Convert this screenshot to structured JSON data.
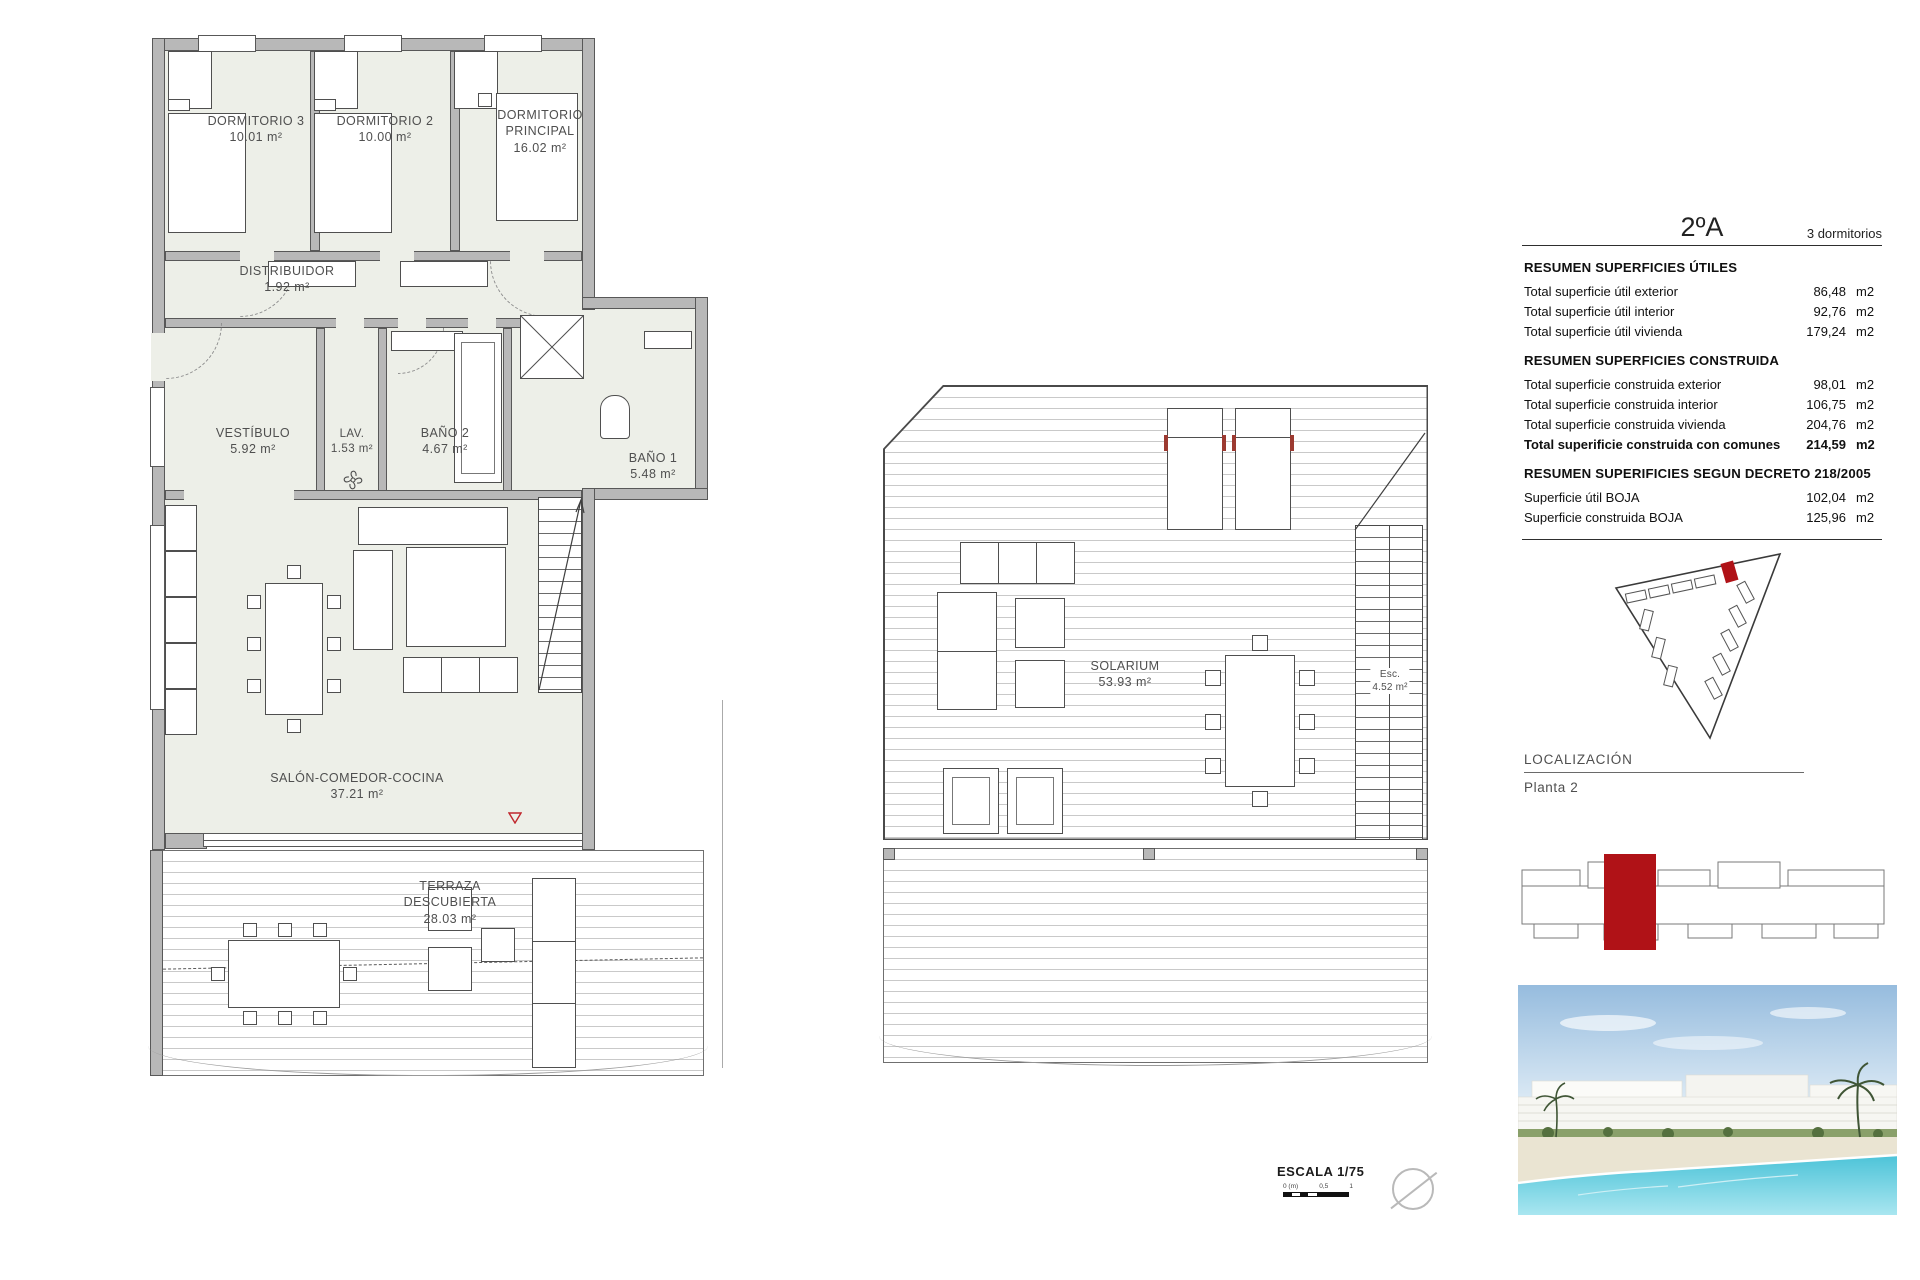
{
  "plan_a": {
    "rooms": [
      {
        "name": "DORMITORIO 3",
        "area": "10.01 m²"
      },
      {
        "name": "DORMITORIO 2",
        "area": "10.00 m²"
      },
      {
        "name": "DORMITORIO PRINCIPAL",
        "area": "16.02 m²"
      },
      {
        "name": "DISTRIBUIDOR",
        "area": "1.92 m²"
      },
      {
        "name": "VESTÍBULO",
        "area": "5.92 m²"
      },
      {
        "name": "LAV.",
        "area": "1.53 m²"
      },
      {
        "name": "BAÑO 2",
        "area": "4.67 m²"
      },
      {
        "name": "BAÑO 1",
        "area": "5.48 m²"
      },
      {
        "name": "SALÓN-COMEDOR-COCINA",
        "area": "37.21 m²"
      },
      {
        "name": "TERRAZA DESCUBIERTA",
        "area": "28.03 m²"
      }
    ]
  },
  "plan_b": {
    "rooms": [
      {
        "name": "SOLARIUM",
        "area": "53.93 m²"
      },
      {
        "name": "Esc.",
        "area": "4.52 m²"
      }
    ]
  },
  "panel": {
    "unit_code": "2ºA",
    "unit_type": "3 dormitorios",
    "sections": [
      {
        "title": "RESUMEN SUPERFICIES ÚTILES",
        "rows": [
          {
            "label": "Total superficie útil exterior",
            "value": "86,48",
            "unit": "m2"
          },
          {
            "label": "Total superficie útil interior",
            "value": "92,76",
            "unit": "m2"
          },
          {
            "label": "Total superficie útil vivienda",
            "value": "179,24",
            "unit": "m2"
          }
        ]
      },
      {
        "title": "RESUMEN SUPERFICIES CONSTRUIDA",
        "rows": [
          {
            "label": "Total superficie construida exterior",
            "value": "98,01",
            "unit": "m2"
          },
          {
            "label": "Total superficie construida interior",
            "value": "106,75",
            "unit": "m2"
          },
          {
            "label": "Total superficie construida vivienda",
            "value": "204,76",
            "unit": "m2"
          },
          {
            "label": "Total superificie construida con comunes",
            "value": "214,59",
            "unit": "m2"
          }
        ]
      },
      {
        "title": "RESUMEN SUPERIFICIES SEGUN DECRETO 218/2005",
        "rows": [
          {
            "label": "Superficie útil BOJA",
            "value": "102,04",
            "unit": "m2"
          },
          {
            "label": "Superficie construida BOJA",
            "value": "125,96",
            "unit": "m2"
          }
        ]
      }
    ]
  },
  "localization": {
    "title": "LOCALIZACIÓN",
    "floor_label": "Planta 2"
  },
  "scale": {
    "label": "ESCALA 1/75",
    "tick_zero": "0 (m)",
    "tick_half": "0,5",
    "tick_one": "1"
  },
  "colors": {
    "accent_red": "#b01217",
    "wall_gray": "#b8b8b8",
    "floor_fill": "#edefe8"
  }
}
